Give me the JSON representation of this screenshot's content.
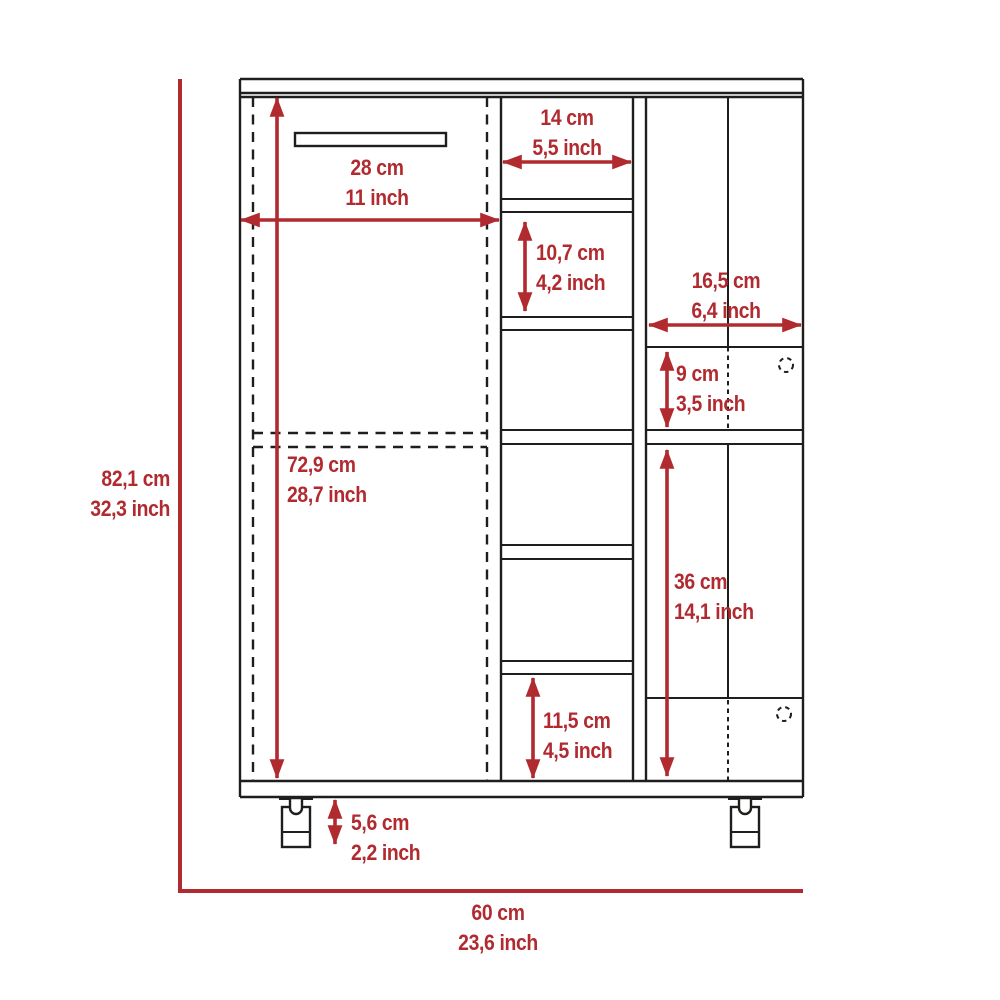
{
  "colors": {
    "dimension_red": "#b12a2f",
    "line_black": "#1e1e1c",
    "background": "#ffffff"
  },
  "dimensions": {
    "cabinet_height": {
      "cm": "82,1 cm",
      "inch": "32,3 inch"
    },
    "cabinet_width": {
      "cm": "60 cm",
      "inch": "23,6 inch"
    },
    "door_width": {
      "cm": "28 cm",
      "inch": "11 inch"
    },
    "door_height": {
      "cm": "72,9 cm",
      "inch": "28,7 inch"
    },
    "cubby_width": {
      "cm": "14 cm",
      "inch": "5,5 inch"
    },
    "cubby_height": {
      "cm": "10,7 cm",
      "inch": "4,2 inch"
    },
    "bottom_cubby_height": {
      "cm": "11,5 cm",
      "inch": "4,5 inch"
    },
    "right_section_width": {
      "cm": "16,5 cm",
      "inch": "6,4 inch"
    },
    "right_cubby_height": {
      "cm": "9 cm",
      "inch": "3,5 inch"
    },
    "right_door_height": {
      "cm": "36 cm",
      "inch": "14,1 inch"
    },
    "caster_height": {
      "cm": "5,6 cm",
      "inch": "2,2 inch"
    }
  }
}
